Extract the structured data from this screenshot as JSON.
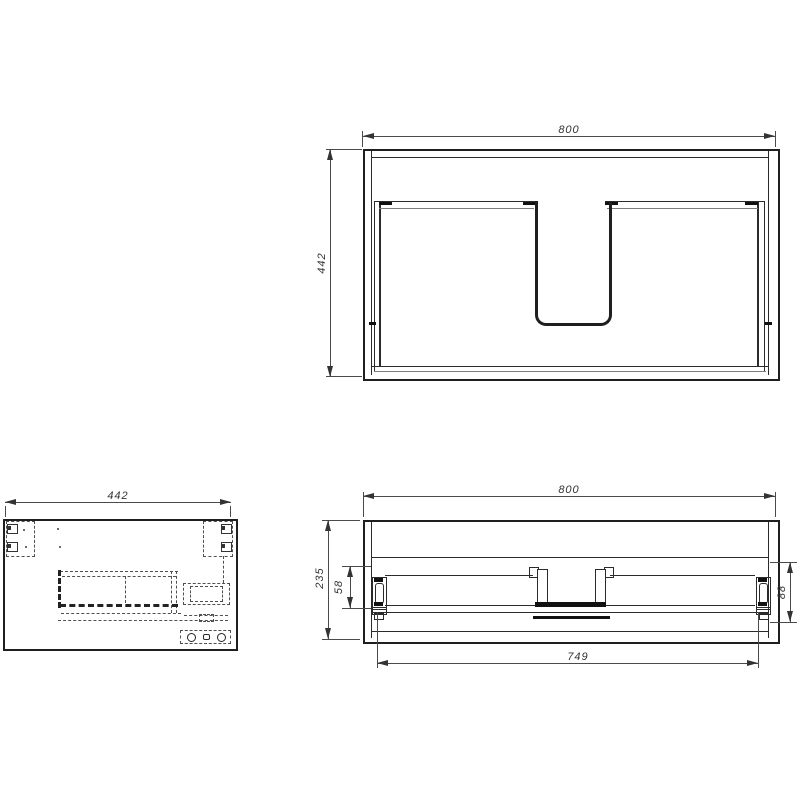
{
  "views": {
    "front": {
      "width_label": "800",
      "height_label": "442"
    },
    "side": {
      "width_label": "442"
    },
    "plan": {
      "width_label": "800",
      "depth_label": "235",
      "slide_height_label": "58",
      "slide_depth_label": "88",
      "runner_span_label": "749"
    }
  },
  "colors": {
    "line": "#1f1f1f",
    "dimension_line": "#4a4a4a",
    "text": "#333333",
    "background": "#ffffff"
  }
}
